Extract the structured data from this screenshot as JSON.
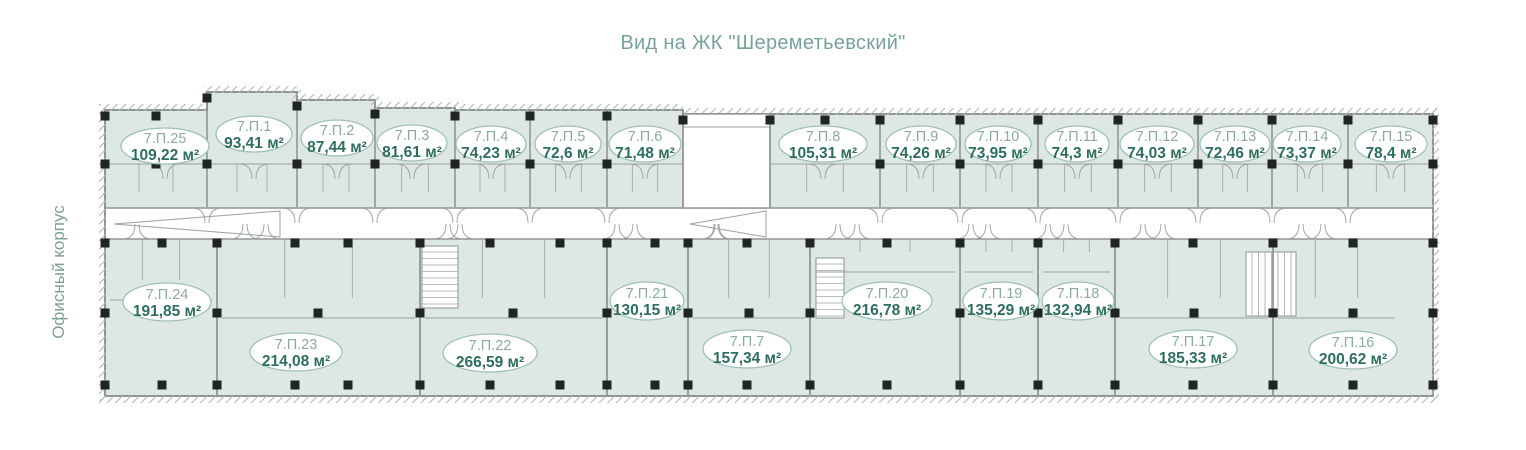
{
  "title": "Вид на ЖК \"Шереметьевский\"",
  "side_label": "Офисный корпус",
  "colors": {
    "title_text": "#77a39c",
    "side_text": "#7ca38f",
    "unit_fill": "#dee8e3",
    "wall": "#8f9593",
    "thin_wall": "#9aa19f",
    "hatch": "#b3b9b7",
    "column": "#1f2522",
    "oval_stroke": "#9fc0b4",
    "oval_fill": "#ffffff",
    "unit_id_text": "#8baaa0",
    "unit_area_text": "#2e6e60"
  },
  "units": [
    {
      "id": "7.П.25",
      "area": "109,22 м²",
      "row": "top",
      "cx": 165,
      "cy": 146,
      "rx": 44,
      "ry": 18
    },
    {
      "id": "7.П.1",
      "area": "93,41 м²",
      "row": "top",
      "cx": 254,
      "cy": 134,
      "rx": 38,
      "ry": 18
    },
    {
      "id": "7.П.2",
      "area": "87,44 м²",
      "row": "top",
      "cx": 337,
      "cy": 138,
      "rx": 36,
      "ry": 18
    },
    {
      "id": "7.П.3",
      "area": "81,61 м²",
      "row": "top",
      "cx": 412,
      "cy": 143,
      "rx": 35,
      "ry": 18
    },
    {
      "id": "7.П.4",
      "area": "74,23 м²",
      "row": "top",
      "cx": 491,
      "cy": 144,
      "rx": 35,
      "ry": 18
    },
    {
      "id": "7.П.5",
      "area": "72,6 м²",
      "row": "top",
      "cx": 568,
      "cy": 144,
      "rx": 33,
      "ry": 18
    },
    {
      "id": "7.П.6",
      "area": "71,48 м²",
      "row": "top",
      "cx": 645,
      "cy": 144,
      "rx": 36,
      "ry": 18
    },
    {
      "id": "7.П.8",
      "area": "105,31 м²",
      "row": "top",
      "cx": 823,
      "cy": 144,
      "rx": 44,
      "ry": 18
    },
    {
      "id": "7.П.9",
      "area": "74,26 м²",
      "row": "top",
      "cx": 921,
      "cy": 144,
      "rx": 35,
      "ry": 18
    },
    {
      "id": "7.П.10",
      "area": "73,95 м²",
      "row": "top",
      "cx": 998,
      "cy": 144,
      "rx": 33,
      "ry": 18
    },
    {
      "id": "7.П.11",
      "area": "74,3 м²",
      "row": "top",
      "cx": 1077,
      "cy": 144,
      "rx": 32,
      "ry": 18
    },
    {
      "id": "7.П.12",
      "area": "74,03 м²",
      "row": "top",
      "cx": 1157,
      "cy": 144,
      "rx": 37,
      "ry": 18
    },
    {
      "id": "7.П.13",
      "area": "72,46 м²",
      "row": "top",
      "cx": 1235,
      "cy": 144,
      "rx": 35,
      "ry": 18
    },
    {
      "id": "7.П.14",
      "area": "73,37 м²",
      "row": "top",
      "cx": 1307,
      "cy": 144,
      "rx": 34,
      "ry": 18
    },
    {
      "id": "7.П.15",
      "area": "78,4 м²",
      "row": "top",
      "cx": 1391,
      "cy": 144,
      "rx": 36,
      "ry": 18
    },
    {
      "id": "7.П.24",
      "area": "191,85 м²",
      "row": "bottom",
      "cx": 167,
      "cy": 302,
      "rx": 44,
      "ry": 19
    },
    {
      "id": "7.П.23",
      "area": "214,08 м²",
      "row": "bottom",
      "cx": 296,
      "cy": 352,
      "rx": 46,
      "ry": 19
    },
    {
      "id": "7.П.22",
      "area": "266,59 м²",
      "row": "bottom",
      "cx": 490,
      "cy": 353,
      "rx": 47,
      "ry": 19
    },
    {
      "id": "7.П.21",
      "area": "130,15 м²",
      "row": "bottom",
      "cx": 647,
      "cy": 301,
      "rx": 37,
      "ry": 19
    },
    {
      "id": "7.П.7",
      "area": "157,34 м²",
      "row": "bottom",
      "cx": 747,
      "cy": 349,
      "rx": 44,
      "ry": 19
    },
    {
      "id": "7.П.20",
      "area": "216,78 м²",
      "row": "bottom",
      "cx": 887,
      "cy": 301,
      "rx": 45,
      "ry": 19
    },
    {
      "id": "7.П.19",
      "area": "135,29 м²",
      "row": "bottom",
      "cx": 1001,
      "cy": 301,
      "rx": 38,
      "ry": 19
    },
    {
      "id": "7.П.18",
      "area": "132,94 м²",
      "row": "bottom",
      "cx": 1078,
      "cy": 301,
      "rx": 36,
      "ry": 19
    },
    {
      "id": "7.П.17",
      "area": "185,33 м²",
      "row": "bottom",
      "cx": 1193,
      "cy": 349,
      "rx": 44,
      "ry": 19
    },
    {
      "id": "7.П.16",
      "area": "200,62 м²",
      "row": "bottom",
      "cx": 1353,
      "cy": 350,
      "rx": 44,
      "ry": 19
    }
  ]
}
